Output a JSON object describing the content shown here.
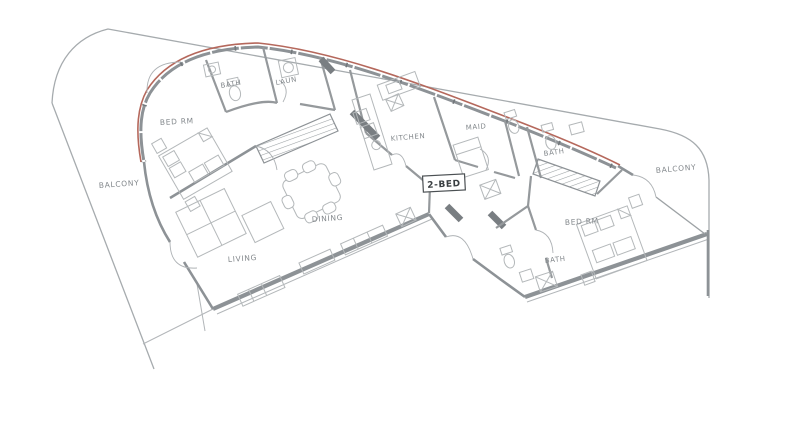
{
  "plan": {
    "unit_type_label": "2-BED",
    "room_labels": {
      "balcony_left": "BALCONY",
      "bed_rm_left": "BED RM",
      "bath_top_left": "BATH",
      "laundry": "LAUN",
      "kitchen": "KITCHEN",
      "maid": "MAID",
      "dining": "DINING",
      "living": "LIVING",
      "bath_upper_right": "BATH",
      "balcony_right": "BALCONY",
      "bed_rm_right": "BED RM",
      "bath_lower_right": "BATH"
    },
    "colors": {
      "background": "#ffffff",
      "wall_gray": "#8d9296",
      "dark_wall": "#797e82",
      "furniture_line": "#b4b8ba",
      "boundary_line": "#a6abae",
      "accent_red": "#b5685c",
      "label_text": "#83888c",
      "unit_label_text": "#3a3f42"
    }
  }
}
